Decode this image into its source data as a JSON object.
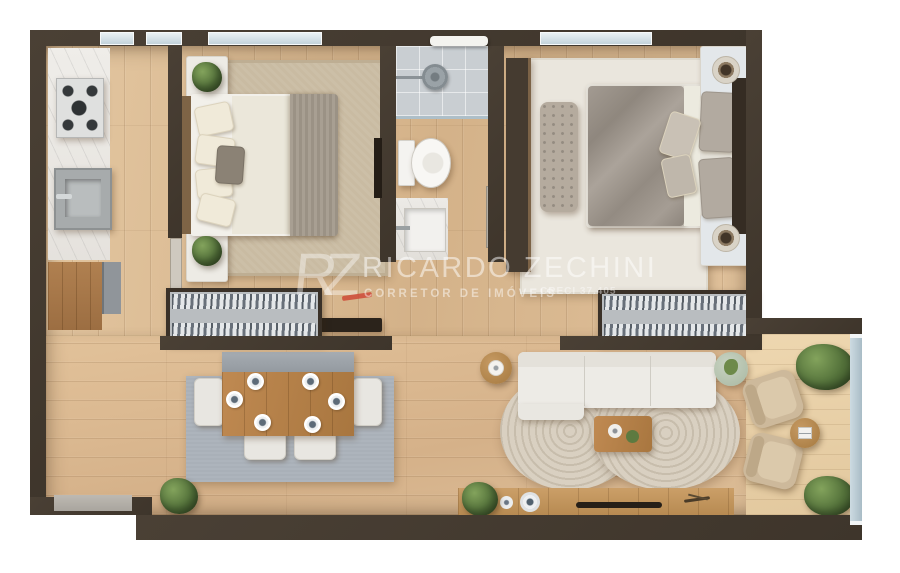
{
  "watermark": {
    "logo": "RZ",
    "brand": "RICARDO ZECHINI",
    "tagline": "CORRETOR DE IMÓVEIS",
    "license": "CRECI 37.405",
    "accent_color": "#cd4534"
  },
  "palette": {
    "wall": "#443a2f",
    "floor_wood": "#dcbd97",
    "balcony_wood": "#e8d0a9",
    "marble": "#edebe6",
    "rug_bedroom1": "#c9bba2",
    "rug_bedroom2": "#eae6dd",
    "rug_dining": "#a9b0b8",
    "rug_living": "#d2c8b8",
    "sofa": "#edebe6",
    "armchair": "#cdb99b",
    "wood_furniture": "#b5834f",
    "glass_railing": "#b7c6ce",
    "greenery": "#53713a"
  },
  "scene": {
    "type": "apartment-floor-plan-3d-top-view",
    "rooms": [
      {
        "id": "kitchen",
        "items": [
          "marble-counter",
          "gas-cooktop",
          "kitchen-sink",
          "base-cabinet",
          "refrigerator"
        ]
      },
      {
        "id": "bedroom-1",
        "items": [
          "double-bed",
          "area-rug",
          "nightstand",
          "nightstand",
          "potted-plant",
          "potted-plant",
          "wall-tv",
          "door"
        ]
      },
      {
        "id": "bathroom",
        "items": [
          "shower",
          "toilet",
          "vanity-sink",
          "towel-rail",
          "door"
        ]
      },
      {
        "id": "bedroom-2",
        "items": [
          "double-bed",
          "wardrobe",
          "tufted-bench",
          "area-rug",
          "nightstand",
          "nightstand",
          "decor-tray",
          "decor-tray"
        ]
      },
      {
        "id": "hallway",
        "items": [
          "bookshelf",
          "tv-panel"
        ]
      },
      {
        "id": "dining-area",
        "items": [
          "dining-table",
          "table-runner",
          "place-settings",
          "chairs",
          "area-rug",
          "potted-plant"
        ]
      },
      {
        "id": "living-area",
        "items": [
          "sofa",
          "organic-round-rug",
          "coffee-table",
          "lamp-side-table",
          "green-pouf",
          "bookshelf",
          "media-bench",
          "vases",
          "potted-plant",
          "entry-threshold"
        ]
      },
      {
        "id": "balcony",
        "items": [
          "armchair",
          "armchair",
          "round-side-table",
          "potted-plant",
          "potted-plant",
          "glass-railing"
        ]
      }
    ]
  }
}
